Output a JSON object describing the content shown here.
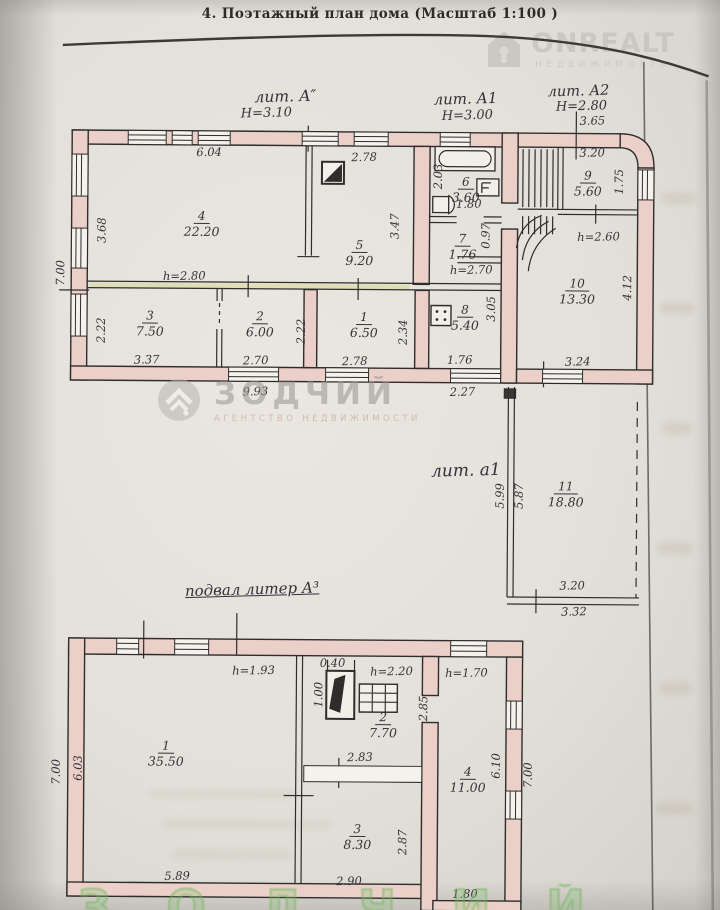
{
  "header": {
    "title": "4. Поэтажный план дома (Масштаб 1:100 )"
  },
  "watermarks": {
    "onrealt": {
      "brand": "ONREALT",
      "tagline": "НЕДВИЖИМОСТЬ"
    },
    "zodchiy": {
      "brand": "ЗОДЧИЙ",
      "tagline": "АГЕНТСТВО НЕДВИЖИМОСТИ"
    }
  },
  "sections": {
    "lit_a": {
      "label": "лит. А″",
      "height": "Н=3.10"
    },
    "lit_a1": {
      "label": "лит. А1",
      "height": "Н=3.00"
    },
    "lit_a2": {
      "label": "лит. А2",
      "height": "Н=2.80"
    },
    "lit_a1_low": {
      "label": "лит. а1"
    },
    "basement": {
      "label": "подвал литер А³"
    }
  },
  "colors": {
    "wall_fill": "#ead0c8",
    "ink": "#2f2d2c",
    "paper": "#e3e0d9",
    "highlight": "#d5d88e",
    "green_watermark": "#69b455",
    "gray_watermark": "#c8c4be"
  },
  "upper_plan": {
    "rooms": [
      {
        "num": "4",
        "area": "22.20",
        "x": 200,
        "y": 206
      },
      {
        "num": "5",
        "area": "9.20",
        "x": 358,
        "y": 234
      },
      {
        "num": "6",
        "area": "3.60",
        "x": 464,
        "y": 170
      },
      {
        "num": "7",
        "area": "1.76",
        "x": 461,
        "y": 227
      },
      {
        "num": "8",
        "area": "5.40",
        "x": 464,
        "y": 298
      },
      {
        "num": "3",
        "area": "7.50",
        "x": 149,
        "y": 306
      },
      {
        "num": "2",
        "area": "6.00",
        "x": 259,
        "y": 306
      },
      {
        "num": "1",
        "area": "6.50",
        "x": 363,
        "y": 306
      },
      {
        "num": "9",
        "area": "5.60",
        "x": 586,
        "y": 163
      },
      {
        "num": "10",
        "area": "13.30",
        "x": 576,
        "y": 271
      },
      {
        "num": "11",
        "area": "18.80",
        "x": 566,
        "y": 474
      }
    ],
    "dims": [
      {
        "t": "6.04",
        "x": 207,
        "y": 153
      },
      {
        "t": "2.78",
        "x": 362,
        "y": 157
      },
      {
        "t": "3.68",
        "x": 100,
        "y": 232,
        "r": 1
      },
      {
        "t": "7.00",
        "x": 59,
        "y": 275,
        "r": 1
      },
      {
        "t": "h=2.80",
        "x": 183,
        "y": 277
      },
      {
        "t": "3.47",
        "x": 393,
        "y": 226,
        "r": 1
      },
      {
        "t": "2.03",
        "x": 436,
        "y": 176,
        "r": 1
      },
      {
        "t": "1.80",
        "x": 467,
        "y": 203
      },
      {
        "t": "0.97",
        "x": 484,
        "y": 235,
        "r": 1
      },
      {
        "t": "h=2.70",
        "x": 470,
        "y": 269
      },
      {
        "t": "3.05",
        "x": 490,
        "y": 308,
        "r": 1
      },
      {
        "t": "1.76",
        "x": 459,
        "y": 359
      },
      {
        "t": "2.27",
        "x": 462,
        "y": 391
      },
      {
        "t": "2.22",
        "x": 100,
        "y": 332,
        "r": 1
      },
      {
        "t": "3.37",
        "x": 146,
        "y": 361
      },
      {
        "t": "2.70",
        "x": 255,
        "y": 361
      },
      {
        "t": "2.22",
        "x": 300,
        "y": 332,
        "r": 1
      },
      {
        "t": "2.78",
        "x": 354,
        "y": 361
      },
      {
        "t": "2.34",
        "x": 402,
        "y": 332,
        "r": 1
      },
      {
        "t": "9.93",
        "x": 255,
        "y": 392
      },
      {
        "t": "3.24",
        "x": 577,
        "y": 360
      },
      {
        "t": "3.65",
        "x": 590,
        "y": 119
      },
      {
        "t": "3.20",
        "x": 590,
        "y": 151
      },
      {
        "t": "1.75",
        "x": 617,
        "y": 180,
        "r": 1
      },
      {
        "t": "h=2.60",
        "x": 597,
        "y": 235
      },
      {
        "t": "4.12",
        "x": 626,
        "y": 286,
        "r": 1
      },
      {
        "t": "5.99",
        "x": 500,
        "y": 495,
        "r": 1
      },
      {
        "t": "5.87",
        "x": 519,
        "y": 495,
        "r": 1
      },
      {
        "t": "3.20",
        "x": 573,
        "y": 584
      },
      {
        "t": "3.32",
        "x": 575,
        "y": 610
      }
    ]
  },
  "basement_plan": {
    "rooms": [
      {
        "num": "1",
        "area": "35.50",
        "x": 168,
        "y": 736
      },
      {
        "num": "2",
        "area": "7.70",
        "x": 385,
        "y": 706
      },
      {
        "num": "3",
        "area": "8.30",
        "x": 360,
        "y": 818
      },
      {
        "num": "4",
        "area": "11.00",
        "x": 470,
        "y": 760
      }
    ],
    "dims": [
      {
        "t": "h=1.93",
        "x": 255,
        "y": 671
      },
      {
        "t": "0.40",
        "x": 334,
        "y": 663
      },
      {
        "t": "1.00",
        "x": 320,
        "y": 695,
        "r": 1
      },
      {
        "t": "h=2.20",
        "x": 393,
        "y": 671
      },
      {
        "t": "h=1.70",
        "x": 468,
        "y": 672
      },
      {
        "t": "2.85",
        "x": 425,
        "y": 708,
        "r": 1
      },
      {
        "t": "2.83",
        "x": 362,
        "y": 757
      },
      {
        "t": "2.87",
        "x": 405,
        "y": 842,
        "r": 1
      },
      {
        "t": "6.03",
        "x": 80,
        "y": 770,
        "r": 1
      },
      {
        "t": "7.00",
        "x": 58,
        "y": 774,
        "r": 1
      },
      {
        "t": "5.89",
        "x": 180,
        "y": 877
      },
      {
        "t": "2.90",
        "x": 352,
        "y": 881
      },
      {
        "t": "1.80",
        "x": 468,
        "y": 893
      },
      {
        "t": "6.10",
        "x": 498,
        "y": 765,
        "r": 1
      },
      {
        "t": "7.00",
        "x": 530,
        "y": 774,
        "r": 1
      }
    ]
  }
}
